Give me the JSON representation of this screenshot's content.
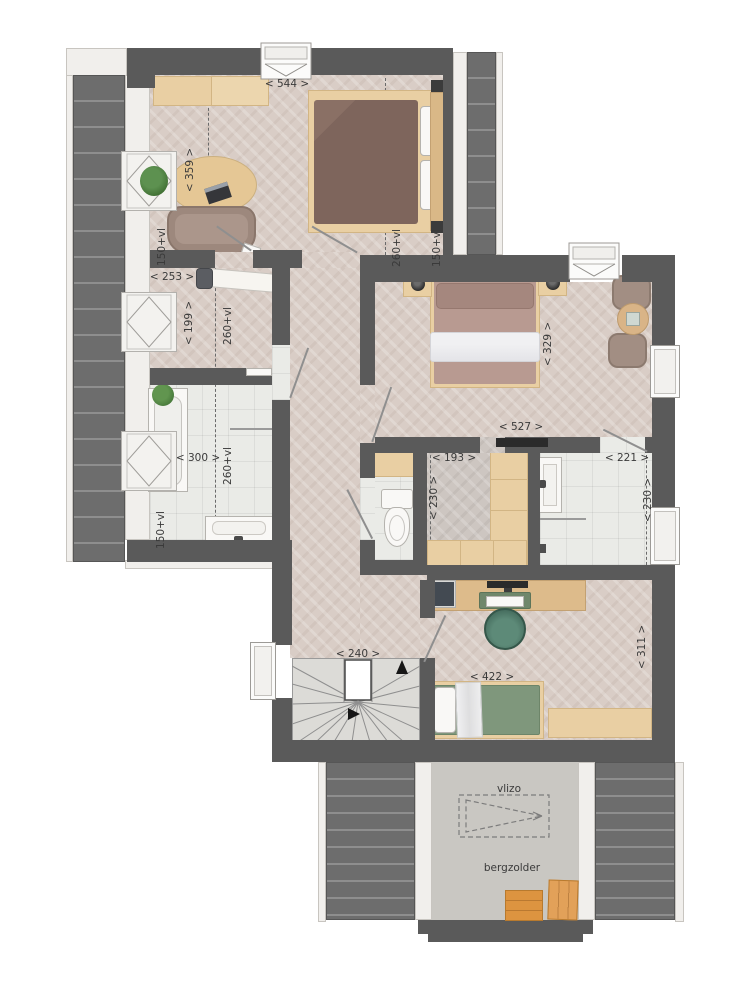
{
  "plan": {
    "rooms": {
      "bedroom1": {
        "width_cm": "< 544 >",
        "depth_cm": "< 359 >",
        "ceiling_left": "150+vl",
        "ceiling_mid": "260+vl",
        "ceiling_right": "150+vl"
      },
      "laundry": {
        "width_cm": "< 253 >",
        "depth_cm": "< 199 >",
        "ceiling": "260+vl"
      },
      "bathroom1": {
        "width_cm": "< 300 >",
        "ceiling": "260+vl",
        "ceiling2": "150+vl"
      },
      "master_bedroom": {
        "width_cm": "< 527 >",
        "depth_cm": "< 329 >"
      },
      "closet": {
        "width_cm": "< 193 >",
        "depth_cm": "< 230 >"
      },
      "bathroom2": {
        "width_cm": "< 221 >",
        "depth_cm": "< 230 >"
      },
      "stairs": {
        "width_cm": "< 240 >"
      },
      "bedroom3": {
        "width_cm": "< 422 >",
        "depth_cm": "< 311 >"
      },
      "attic": {
        "hatch_label": "vlizo",
        "name": "bergzolder"
      }
    },
    "colors": {
      "wall": "#5a5a5a",
      "roof": "#6d6d6d",
      "floor_wood": "#d9cdc6",
      "floor_tile": "#eaebe7",
      "accent_wood": "#e9cfa3"
    }
  }
}
